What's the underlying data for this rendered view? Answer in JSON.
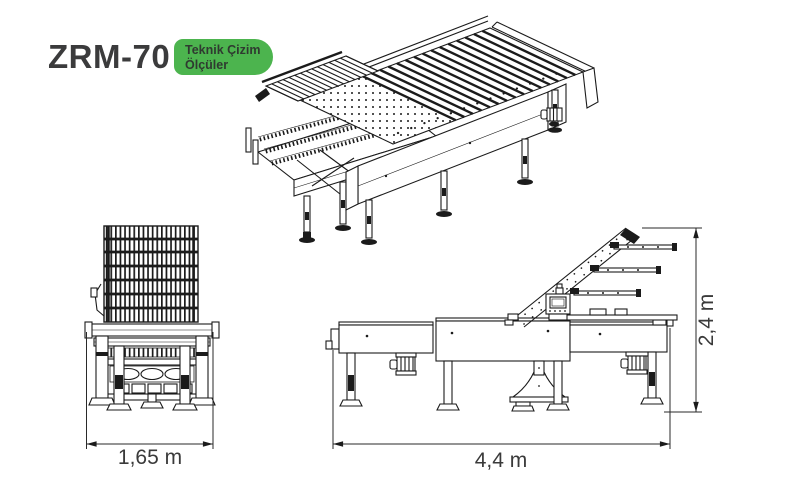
{
  "theme": {
    "accent-green": "#4cb44e",
    "title-color": "#3b3b3c",
    "dim-text-color": "#3a3a3a",
    "background": "#ffffff",
    "line-color": "#1b1b1b"
  },
  "header": {
    "model": "ZRM-70",
    "badge": {
      "line1": "Teknik Çizim",
      "line2": "Ölçüler"
    }
  },
  "drawing": {
    "dimensions": {
      "front_width": "1,65 m",
      "side_length": "4,4 m",
      "side_height": "2,4 m"
    }
  }
}
